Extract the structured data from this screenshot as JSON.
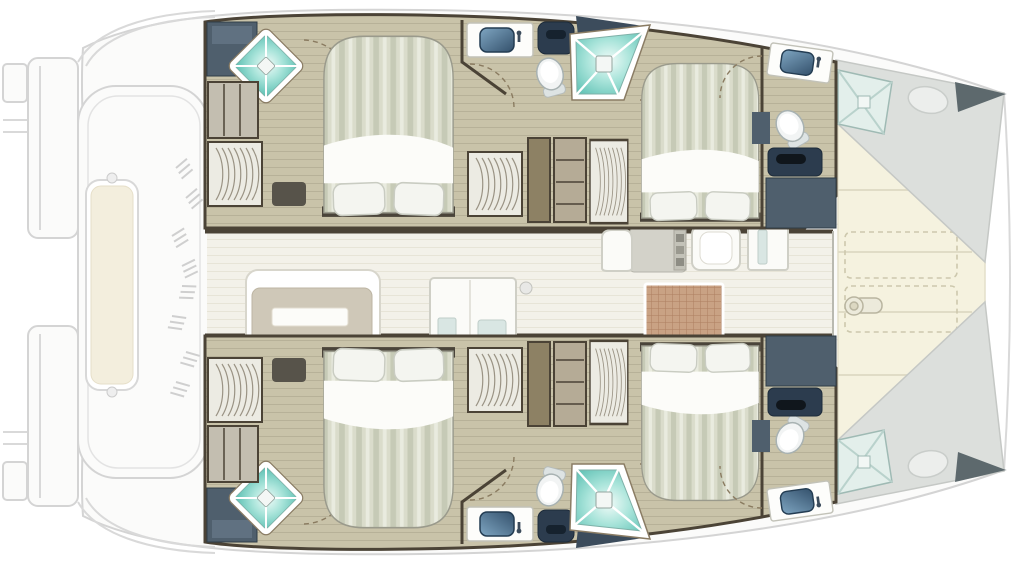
{
  "meta": {
    "title": "Catamaran interior deck plan",
    "view": "top-down floor plan",
    "orientation": "bow to the right, stern to the left"
  },
  "colors": {
    "wall": "#4b4336",
    "floor": "#c9c3a9",
    "floorLine": "#b7b198",
    "salonFloor": "#f3f1e9",
    "salonFloorLine": "#e7e4d7",
    "slate": "#4f5f6d",
    "slateDark": "#3c4c5c",
    "navy": "#2c3c4e",
    "showerLight": "#f0fbf8",
    "showerMid": "#a9e4da",
    "showerDeep": "#57bdb0",
    "basinLight": "#7fa6c2",
    "basinDark": "#33506b",
    "bedStripeA": "#dadccb",
    "bedStripeB": "#c6cab6",
    "bedStripeC": "#e9ebdf",
    "trampoline": "#f5f2df",
    "trampolineSeam": "#e0dcc6",
    "benchCream": "#f3eedd",
    "mat": "#c9a284",
    "matLine": "#ad7f60",
    "tableBeige": "#cfc8b8",
    "deckBand": "#dcdfdc",
    "bowTip": "#5d696d"
  },
  "regions": {
    "port_hull": {
      "label": "Port hull (top)",
      "aft_shower_room": {
        "label": "Aft shower room",
        "fixtures": [
          "shower",
          "shelf unit",
          "hanging locker"
        ]
      },
      "aft_cabin": {
        "label": "Port aft cabin",
        "bed": "island double bed",
        "pillows": 2
      },
      "mid_head": {
        "label": "Mid head",
        "fixtures": [
          "sink",
          "toilet",
          "shower",
          "vanity cabinet"
        ]
      },
      "fwd_cabin": {
        "label": "Port forward cabin",
        "bed": "island double bed",
        "pillows": 2
      },
      "fwd_head": {
        "label": "Forward head",
        "fixtures": [
          "sink",
          "toilet",
          "cabinet"
        ]
      }
    },
    "starboard_hull": {
      "label": "Starboard hull (bottom, mirror of port hull)",
      "aft_shower_room": {
        "label": "Aft shower room",
        "fixtures": [
          "shower",
          "shelf unit",
          "hanging locker"
        ]
      },
      "aft_cabin": {
        "label": "Starboard aft cabin",
        "bed": "island double bed",
        "pillows": 2
      },
      "mid_head": {
        "label": "Mid head",
        "fixtures": [
          "sink",
          "toilet",
          "shower",
          "vanity cabinet"
        ]
      },
      "fwd_cabin": {
        "label": "Starboard forward cabin",
        "bed": "island double bed",
        "pillows": 2
      },
      "fwd_head": {
        "label": "Forward head",
        "fixtures": [
          "sink",
          "toilet",
          "cabinet"
        ]
      }
    },
    "salon": {
      "label": "Salon / galley on bridge deck",
      "furniture": [
        "dinette table with bench",
        "storage cabinet",
        "nav seat",
        "chart desk",
        "galley modules",
        "woven floor mat",
        "deck light"
      ]
    },
    "cockpit": {
      "label": "Aft cockpit (ghosted)",
      "furniture": [
        "transverse bench seat"
      ]
    },
    "foredeck": {
      "label": "Bow trampoline",
      "features": [
        "net panels",
        "windlass",
        "deck hatches",
        "forepeak berths",
        "bow tips"
      ]
    },
    "transoms": {
      "label": "Swim platforms / transom steps",
      "count": 2
    }
  }
}
